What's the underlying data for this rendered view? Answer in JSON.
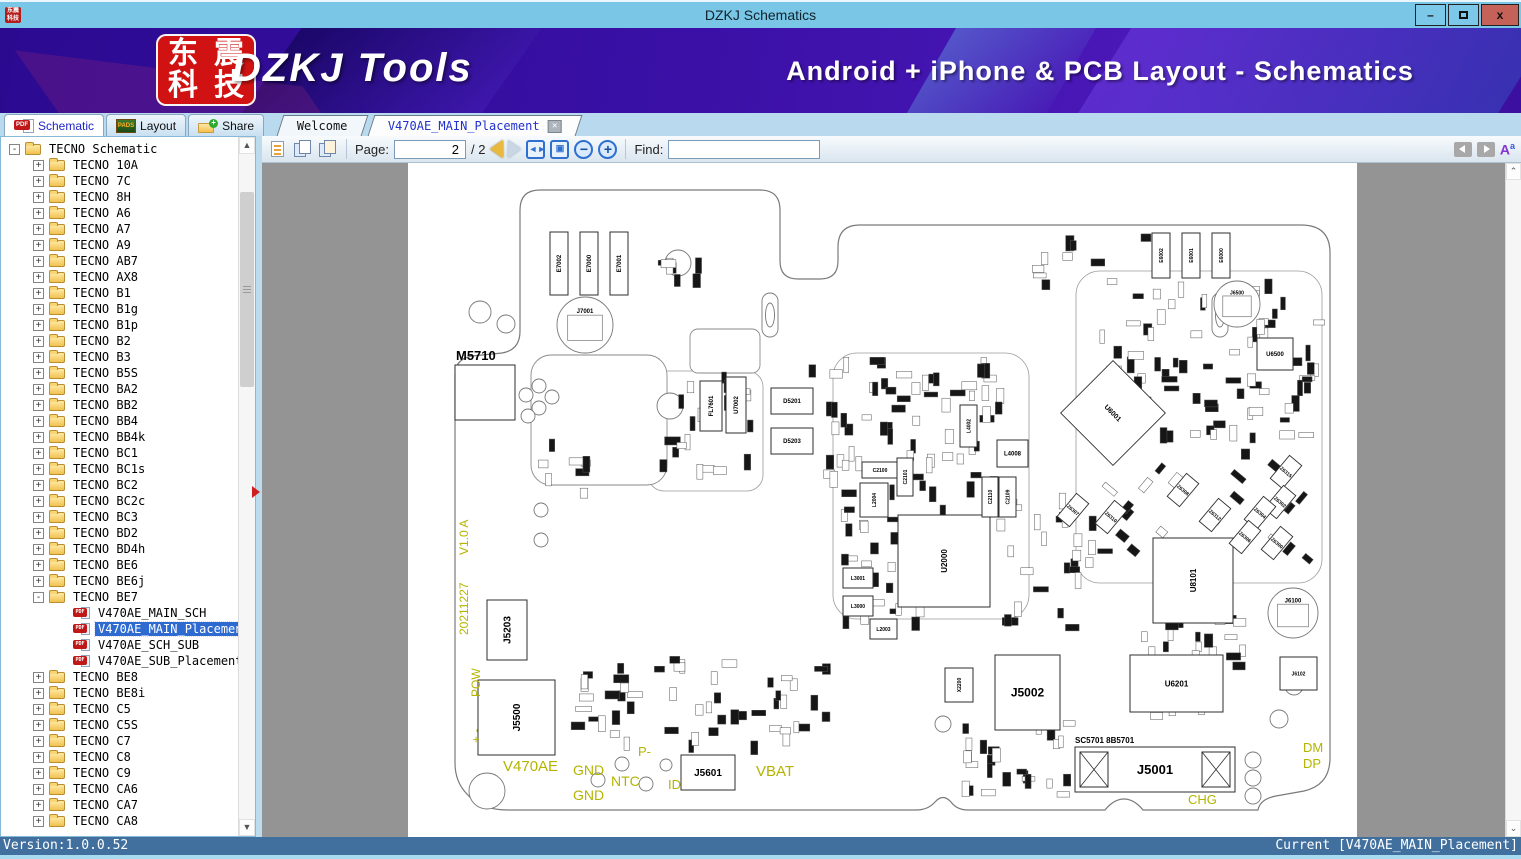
{
  "window": {
    "title": "DZKJ Schematics",
    "minimize": "–",
    "maximize": "",
    "close": "x"
  },
  "banner": {
    "logo_chars": [
      "东",
      "震",
      "科",
      "技"
    ],
    "app_name": "DZKJ Tools",
    "subtitle": "Android + iPhone & PCB Layout - Schematics"
  },
  "ribbon_tabs": [
    {
      "label": "Schematic",
      "icon": "pdf",
      "active": true
    },
    {
      "label": "Layout",
      "icon": "pads",
      "active": false
    },
    {
      "label": "Share",
      "icon": "share",
      "active": false
    }
  ],
  "doc_tabs": [
    {
      "label": "Welcome",
      "active": false,
      "closable": false
    },
    {
      "label": "V470AE_MAIN_Placement",
      "active": true,
      "closable": true
    }
  ],
  "toolbar": {
    "page_label": "Page:",
    "page_value": "2",
    "page_total": "/ 2",
    "find_label": "Find:",
    "find_value": ""
  },
  "tree": {
    "items": [
      {
        "label": "TECNO Schematic",
        "kind": "folder",
        "depth": 0,
        "exp": "-"
      },
      {
        "label": "TECNO 10A",
        "kind": "folder",
        "depth": 1,
        "exp": "+"
      },
      {
        "label": "TECNO 7C",
        "kind": "folder",
        "depth": 1,
        "exp": "+"
      },
      {
        "label": "TECNO 8H",
        "kind": "folder",
        "depth": 1,
        "exp": "+"
      },
      {
        "label": "TECNO A6",
        "kind": "folder",
        "depth": 1,
        "exp": "+"
      },
      {
        "label": "TECNO A7",
        "kind": "folder",
        "depth": 1,
        "exp": "+"
      },
      {
        "label": "TECNO A9",
        "kind": "folder",
        "depth": 1,
        "exp": "+"
      },
      {
        "label": "TECNO AB7",
        "kind": "folder",
        "depth": 1,
        "exp": "+"
      },
      {
        "label": "TECNO AX8",
        "kind": "folder",
        "depth": 1,
        "exp": "+"
      },
      {
        "label": "TECNO B1",
        "kind": "folder",
        "depth": 1,
        "exp": "+"
      },
      {
        "label": "TECNO B1g",
        "kind": "folder",
        "depth": 1,
        "exp": "+"
      },
      {
        "label": "TECNO B1p",
        "kind": "folder",
        "depth": 1,
        "exp": "+"
      },
      {
        "label": "TECNO B2",
        "kind": "folder",
        "depth": 1,
        "exp": "+"
      },
      {
        "label": "TECNO B3",
        "kind": "folder",
        "depth": 1,
        "exp": "+"
      },
      {
        "label": "TECNO B5S",
        "kind": "folder",
        "depth": 1,
        "exp": "+"
      },
      {
        "label": "TECNO BA2",
        "kind": "folder",
        "depth": 1,
        "exp": "+"
      },
      {
        "label": "TECNO BB2",
        "kind": "folder",
        "depth": 1,
        "exp": "+"
      },
      {
        "label": "TECNO BB4",
        "kind": "folder",
        "depth": 1,
        "exp": "+"
      },
      {
        "label": "TECNO BB4k",
        "kind": "folder",
        "depth": 1,
        "exp": "+"
      },
      {
        "label": "TECNO BC1",
        "kind": "folder",
        "depth": 1,
        "exp": "+"
      },
      {
        "label": "TECNO BC1s",
        "kind": "folder",
        "depth": 1,
        "exp": "+"
      },
      {
        "label": "TECNO BC2",
        "kind": "folder",
        "depth": 1,
        "exp": "+"
      },
      {
        "label": "TECNO BC2c",
        "kind": "folder",
        "depth": 1,
        "exp": "+"
      },
      {
        "label": "TECNO BC3",
        "kind": "folder",
        "depth": 1,
        "exp": "+"
      },
      {
        "label": "TECNO BD2",
        "kind": "folder",
        "depth": 1,
        "exp": "+"
      },
      {
        "label": "TECNO BD4h",
        "kind": "folder",
        "depth": 1,
        "exp": "+"
      },
      {
        "label": "TECNO BE6",
        "kind": "folder",
        "depth": 1,
        "exp": "+"
      },
      {
        "label": "TECNO BE6j",
        "kind": "folder",
        "depth": 1,
        "exp": "+"
      },
      {
        "label": "TECNO BE7",
        "kind": "folder",
        "depth": 1,
        "exp": "-"
      },
      {
        "label": "V470AE_MAIN_SCH",
        "kind": "pdf",
        "depth": 2,
        "exp": ""
      },
      {
        "label": "V470AE_MAIN_Placement",
        "kind": "pdf",
        "depth": 2,
        "exp": "",
        "selected": true
      },
      {
        "label": "V470AE_SCH_SUB",
        "kind": "pdf",
        "depth": 2,
        "exp": ""
      },
      {
        "label": "V470AE_SUB_Placement",
        "kind": "pdf",
        "depth": 2,
        "exp": ""
      },
      {
        "label": "TECNO BE8",
        "kind": "folder",
        "depth": 1,
        "exp": "+"
      },
      {
        "label": "TECNO BE8i",
        "kind": "folder",
        "depth": 1,
        "exp": "+"
      },
      {
        "label": "TECNO C5",
        "kind": "folder",
        "depth": 1,
        "exp": "+"
      },
      {
        "label": "TECNO C5S",
        "kind": "folder",
        "depth": 1,
        "exp": "+"
      },
      {
        "label": "TECNO C7",
        "kind": "folder",
        "depth": 1,
        "exp": "+"
      },
      {
        "label": "TECNO C8",
        "kind": "folder",
        "depth": 1,
        "exp": "+"
      },
      {
        "label": "TECNO C9",
        "kind": "folder",
        "depth": 1,
        "exp": "+"
      },
      {
        "label": "TECNO CA6",
        "kind": "folder",
        "depth": 1,
        "exp": "+"
      },
      {
        "label": "TECNO CA7",
        "kind": "folder",
        "depth": 1,
        "exp": "+"
      },
      {
        "label": "TECNO CA8",
        "kind": "folder",
        "depth": 1,
        "exp": "+"
      }
    ]
  },
  "status": {
    "version": "Version:1.0.0.52",
    "current": "Current [V470AE_MAIN_Placement]"
  },
  "pcb": {
    "yellow": "#b4b400",
    "outline": "M 140,27 L 352,27 Q 372,27 372,47 L 372,98 Q 372,116 390,116 L 412,116 Q 430,116 430,98 L 430,84 Q 430,62 452,62 L 893,62 Q 922,62 922,90 L 922,595 Q 922,622 896,628 L 868,633 Q 852,636 850,647 L 735,647 Q 726,636 716,636 Q 706,636 697,647 L 560,647 Q 549,647 543,639 Q 535,630 527,639 Q 520,647 508,647 L 100,647 Q 72,647 58,630 Q 47,618 47,600 L 47,212 Q 47,196 64,193 L 94,190 Q 112,187 112,168 L 112,47 Q 112,27 132,27 Z",
    "sections": [
      {
        "x": 425,
        "y": 190,
        "w": 196,
        "h": 266,
        "r": 24
      },
      {
        "x": 668,
        "y": 108,
        "w": 246,
        "h": 312,
        "r": 24
      },
      {
        "x": 240,
        "y": 208,
        "w": 115,
        "h": 120,
        "r": 16
      }
    ],
    "keepouts": [
      {
        "x": 123,
        "y": 192,
        "w": 136,
        "h": 130,
        "r": 20
      },
      {
        "x": 282,
        "y": 166,
        "w": 70,
        "h": 44,
        "r": 8
      }
    ],
    "chips": [
      {
        "x": 47,
        "y": 202,
        "w": 60,
        "h": 55,
        "t": "",
        "fs": 0
      },
      {
        "x": 142,
        "y": 69,
        "w": 18,
        "h": 63,
        "t": "E7002",
        "rot": -90,
        "fs": 6
      },
      {
        "x": 172,
        "y": 69,
        "w": 18,
        "h": 63,
        "t": "E7000",
        "rot": -90,
        "fs": 6
      },
      {
        "x": 202,
        "y": 69,
        "w": 18,
        "h": 63,
        "t": "E7001",
        "rot": -90,
        "fs": 6
      },
      {
        "x": 292,
        "y": 218,
        "w": 22,
        "h": 50,
        "t": "FL7601",
        "rot": -90,
        "fs": 6
      },
      {
        "x": 318,
        "y": 214,
        "w": 20,
        "h": 56,
        "t": "U7002",
        "rot": -90,
        "fs": 6
      },
      {
        "x": 363,
        "y": 225,
        "w": 42,
        "h": 26,
        "t": "D5201",
        "fs": 6
      },
      {
        "x": 363,
        "y": 265,
        "w": 42,
        "h": 26,
        "t": "D5203",
        "fs": 6
      },
      {
        "x": 79,
        "y": 437,
        "w": 40,
        "h": 60,
        "t": "J5203",
        "rot": -90,
        "fs": 10
      },
      {
        "x": 70,
        "y": 517,
        "w": 77,
        "h": 75,
        "t": "J5500",
        "rot": -90,
        "fs": 10
      },
      {
        "x": 273,
        "y": 592,
        "w": 54,
        "h": 35,
        "t": "J5601",
        "fs": 10
      },
      {
        "x": 587,
        "y": 492,
        "w": 65,
        "h": 75,
        "t": "J5002",
        "fs": 12
      },
      {
        "x": 537,
        "y": 505,
        "w": 28,
        "h": 34,
        "t": "X2200",
        "rot": -90,
        "fs": 5
      },
      {
        "x": 722,
        "y": 492,
        "w": 93,
        "h": 57,
        "t": "U6201",
        "fs": 8
      },
      {
        "x": 667,
        "y": 584,
        "w": 160,
        "h": 45,
        "t": "J5001",
        "fs": 13
      },
      {
        "x": 745,
        "y": 375,
        "w": 80,
        "h": 85,
        "t": "U8101",
        "rot": -90,
        "fs": 8
      },
      {
        "x": 849,
        "y": 175,
        "w": 36,
        "h": 32,
        "t": "U6500",
        "fs": 6
      },
      {
        "x": 872,
        "y": 494,
        "w": 37,
        "h": 33,
        "t": "J6102",
        "fs": 5
      },
      {
        "x": 490,
        "y": 352,
        "w": 92,
        "h": 92,
        "t": "U2000",
        "rot": -90,
        "fs": 8
      },
      {
        "x": 454,
        "y": 299,
        "w": 36,
        "h": 16,
        "t": "C2100",
        "fs": 5
      },
      {
        "x": 489,
        "y": 295,
        "w": 16,
        "h": 38,
        "t": "C2101",
        "rot": -90,
        "fs": 5
      },
      {
        "x": 452,
        "y": 320,
        "w": 28,
        "h": 34,
        "t": "L2004",
        "rot": -90,
        "fs": 5
      },
      {
        "x": 435,
        "y": 405,
        "w": 30,
        "h": 20,
        "t": "L3001",
        "fs": 5
      },
      {
        "x": 435,
        "y": 433,
        "w": 30,
        "h": 20,
        "t": "L3000",
        "fs": 5
      },
      {
        "x": 462,
        "y": 456,
        "w": 27,
        "h": 20,
        "t": "L2003",
        "fs": 5
      },
      {
        "x": 552,
        "y": 242,
        "w": 17,
        "h": 42,
        "t": "L4002",
        "rot": -90,
        "fs": 5
      },
      {
        "x": 589,
        "y": 277,
        "w": 31,
        "h": 27,
        "t": "L4008",
        "fs": 6
      },
      {
        "x": 574,
        "y": 314,
        "w": 16,
        "h": 40,
        "t": "C2110",
        "rot": -90,
        "fs": 5
      },
      {
        "x": 591,
        "y": 314,
        "w": 17,
        "h": 40,
        "t": "C2109",
        "rot": -90,
        "fs": 5
      },
      {
        "x": 744,
        "y": 70,
        "w": 18,
        "h": 45,
        "t": "E6002",
        "rot": -90,
        "fs": 5
      },
      {
        "x": 774,
        "y": 70,
        "w": 18,
        "h": 45,
        "t": "E6001",
        "rot": -90,
        "fs": 5
      },
      {
        "x": 804,
        "y": 70,
        "w": 18,
        "h": 45,
        "t": "E6000",
        "rot": -90,
        "fs": 5
      }
    ],
    "rot_chips": [
      {
        "cx": 705,
        "cy": 250,
        "w": 74,
        "h": 74,
        "ang": 45,
        "t": "U6001",
        "fs": 7
      },
      {
        "cx": 665,
        "cy": 347,
        "w": 16,
        "h": 30,
        "ang": 40,
        "t": "Z6307",
        "fs": 5
      },
      {
        "cx": 703,
        "cy": 354,
        "w": 16,
        "h": 30,
        "ang": 40,
        "t": "Z6310",
        "fs": 5
      },
      {
        "cx": 775,
        "cy": 327,
        "w": 16,
        "h": 30,
        "ang": 40,
        "t": "Z6308",
        "fs": 5
      },
      {
        "cx": 807,
        "cy": 352,
        "w": 16,
        "h": 30,
        "ang": 40,
        "t": "Z6312",
        "fs": 5
      },
      {
        "cx": 878,
        "cy": 309,
        "w": 16,
        "h": 30,
        "ang": 40,
        "t": "Z6315",
        "fs": 5
      },
      {
        "cx": 872,
        "cy": 339,
        "w": 16,
        "h": 30,
        "ang": 40,
        "t": "Z6302",
        "fs": 5
      },
      {
        "cx": 852,
        "cy": 350,
        "w": 16,
        "h": 30,
        "ang": 40,
        "t": "Z6304",
        "fs": 5
      },
      {
        "cx": 837,
        "cy": 374,
        "w": 16,
        "h": 30,
        "ang": 40,
        "t": "Z6306",
        "fs": 5
      },
      {
        "cx": 869,
        "cy": 380,
        "w": 16,
        "h": 30,
        "ang": 40,
        "t": "Z6300",
        "fs": 5
      }
    ],
    "big_circles": [
      {
        "x": 177,
        "y": 162,
        "r": 28,
        "t": "J7001",
        "fs": 6
      },
      {
        "x": 829,
        "y": 141,
        "r": 23,
        "t": "J6500",
        "fs": 5
      },
      {
        "x": 885,
        "y": 450,
        "r": 25,
        "t": "J6100",
        "fs": 6
      }
    ],
    "circles": [
      {
        "x": 72,
        "y": 149,
        "r": 11
      },
      {
        "x": 98,
        "y": 161,
        "r": 9
      },
      {
        "x": 262,
        "y": 243,
        "r": 13
      },
      {
        "x": 270,
        "y": 100,
        "r": 13
      },
      {
        "x": 79,
        "y": 628,
        "r": 18
      },
      {
        "x": 190,
        "y": 617,
        "r": 7
      },
      {
        "x": 214,
        "y": 601,
        "r": 7
      },
      {
        "x": 238,
        "y": 621,
        "r": 7
      },
      {
        "x": 258,
        "y": 602,
        "r": 6
      },
      {
        "x": 845,
        "y": 597,
        "r": 8
      },
      {
        "x": 845,
        "y": 615,
        "r": 8
      },
      {
        "x": 845,
        "y": 633,
        "r": 8
      },
      {
        "x": 133,
        "y": 347,
        "r": 7
      },
      {
        "x": 133,
        "y": 377,
        "r": 7
      },
      {
        "x": 118,
        "y": 232,
        "r": 7
      },
      {
        "x": 131,
        "y": 223,
        "r": 7
      },
      {
        "x": 131,
        "y": 245,
        "r": 7
      },
      {
        "x": 144,
        "y": 234,
        "r": 7
      },
      {
        "x": 120,
        "y": 253,
        "r": 7
      },
      {
        "x": 535,
        "y": 561,
        "r": 8
      },
      {
        "x": 122,
        "y": 557,
        "r": 9
      },
      {
        "x": 886,
        "y": 523,
        "r": 9
      },
      {
        "x": 871,
        "y": 556,
        "r": 9
      },
      {
        "x": 130,
        "y": 578,
        "r": 7
      }
    ],
    "slots": [
      {
        "x": 362,
        "y": 150
      },
      {
        "x": 812,
        "y": 150
      }
    ],
    "hatches": [
      {
        "x": 672,
        "y": 589,
        "w": 28,
        "h": 35
      },
      {
        "x": 794,
        "y": 589,
        "w": 28,
        "h": 35
      }
    ],
    "labels": [
      {
        "t": "M5710",
        "x": 48,
        "y": 197,
        "fs": 13,
        "col": "k",
        "b": true
      },
      {
        "t": "SC5701 8B5701",
        "x": 667,
        "y": 580,
        "fs": 8,
        "col": "k",
        "b": true
      },
      {
        "t": "V1.0 A",
        "x": 60,
        "y": 392,
        "fs": 12,
        "col": "y",
        "rot": -90
      },
      {
        "t": "20211227",
        "x": 60,
        "y": 472,
        "fs": 12,
        "col": "y",
        "rot": -90
      },
      {
        "t": "POW",
        "x": 72,
        "y": 534,
        "fs": 12,
        "col": "y",
        "rot": -90
      },
      {
        "t": "+  -",
        "x": 72,
        "y": 580,
        "fs": 12,
        "col": "y",
        "rot": -90
      },
      {
        "t": "V470AE",
        "x": 95,
        "y": 608,
        "fs": 15,
        "col": "y"
      },
      {
        "t": "GND",
        "x": 165,
        "y": 612,
        "fs": 14,
        "col": "y"
      },
      {
        "t": "GND",
        "x": 165,
        "y": 637,
        "fs": 14,
        "col": "y"
      },
      {
        "t": "NTC",
        "x": 203,
        "y": 623,
        "fs": 14,
        "col": "y"
      },
      {
        "t": "P-",
        "x": 230,
        "y": 593,
        "fs": 13,
        "col": "y"
      },
      {
        "t": "ID",
        "x": 260,
        "y": 626,
        "fs": 13,
        "col": "y"
      },
      {
        "t": "VBAT",
        "x": 348,
        "y": 613,
        "fs": 15,
        "col": "y"
      },
      {
        "t": "CHG",
        "x": 780,
        "y": 641,
        "fs": 13,
        "col": "y"
      },
      {
        "t": "DM",
        "x": 895,
        "y": 589,
        "fs": 13,
        "col": "y"
      },
      {
        "t": "DP",
        "x": 895,
        "y": 605,
        "fs": 13,
        "col": "y"
      }
    ],
    "clusters": [
      {
        "x": 250,
        "y": 200,
        "w": 90,
        "h": 105,
        "n": 24,
        "ang": 0
      },
      {
        "x": 398,
        "y": 192,
        "w": 195,
        "h": 145,
        "n": 66,
        "ang": 0
      },
      {
        "x": 432,
        "y": 340,
        "w": 140,
        "h": 115,
        "n": 38,
        "ang": 0
      },
      {
        "x": 588,
        "y": 330,
        "w": 105,
        "h": 135,
        "n": 28,
        "ang": 0
      },
      {
        "x": 622,
        "y": 64,
        "w": 125,
        "h": 55,
        "n": 12,
        "ang": 0
      },
      {
        "x": 682,
        "y": 116,
        "w": 225,
        "h": 170,
        "n": 76,
        "ang": 0
      },
      {
        "x": 698,
        "y": 292,
        "w": 205,
        "h": 115,
        "n": 24,
        "ang": -50
      },
      {
        "x": 152,
        "y": 492,
        "w": 265,
        "h": 86,
        "n": 52,
        "ang": 0
      },
      {
        "x": 542,
        "y": 556,
        "w": 115,
        "h": 78,
        "n": 26,
        "ang": 0
      },
      {
        "x": 720,
        "y": 452,
        "w": 112,
        "h": 105,
        "n": 34,
        "ang": 0
      },
      {
        "x": 244,
        "y": 92,
        "w": 55,
        "h": 20,
        "n": 7,
        "ang": 0
      },
      {
        "x": 130,
        "y": 270,
        "w": 60,
        "h": 60,
        "n": 8,
        "ang": 0
      }
    ]
  }
}
